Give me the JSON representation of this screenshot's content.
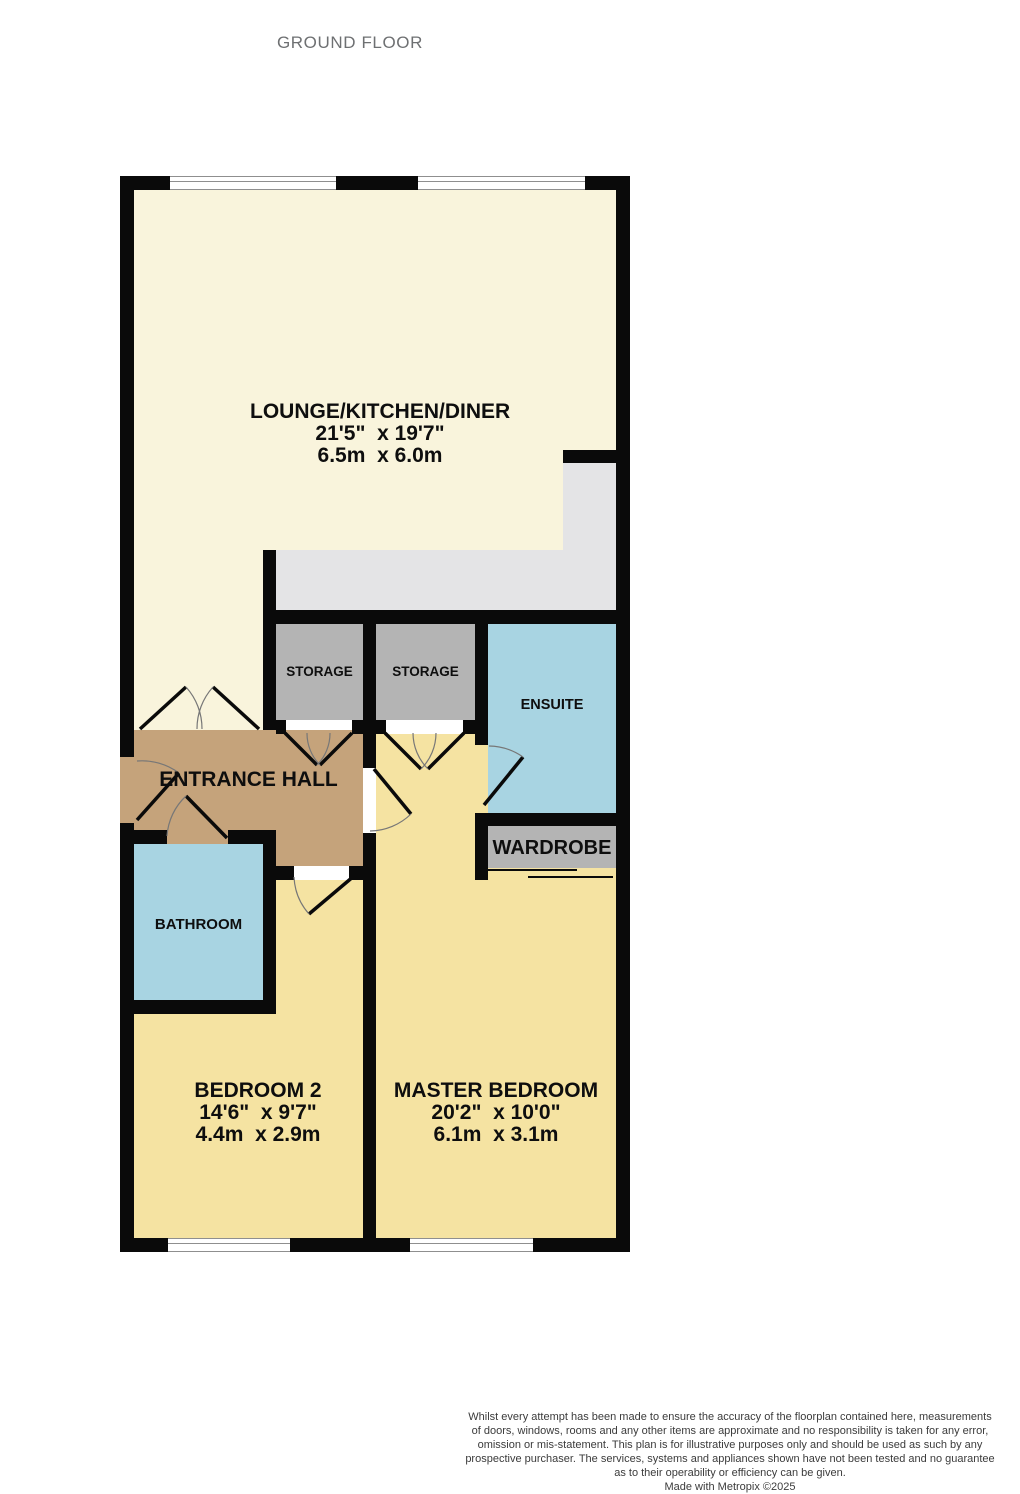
{
  "title": "GROUND FLOOR",
  "rooms": {
    "lounge": {
      "name": "LOUNGE/KITCHEN/DINER",
      "imperial": "21'5\"  x 19'7\"",
      "metric": "6.5m  x 6.0m"
    },
    "storage1": {
      "name": "STORAGE"
    },
    "storage2": {
      "name": "STORAGE"
    },
    "ensuite": {
      "name": "ENSUITE"
    },
    "entrance_hall": {
      "name": "ENTRANCE HALL"
    },
    "wardrobe": {
      "name": "WARDROBE"
    },
    "bathroom": {
      "name": "BATHROOM"
    },
    "bedroom2": {
      "name": "BEDROOM 2",
      "imperial": "14'6\"  x 9'7\"",
      "metric": "4.4m  x 2.9m"
    },
    "master": {
      "name": "MASTER BEDROOM",
      "imperial": "20'2\"  x 10'0\"",
      "metric": "6.1m  x 3.1m"
    }
  },
  "colors": {
    "wall": "#0a0a0a",
    "lounge": "#f9f4dc",
    "bedroom": "#f5e3a2",
    "hall": "#c5a37b",
    "storage": "#b4b4b4",
    "kitchen": "#e4e4e6",
    "bath": "#a8d4e2",
    "title": "#6e7072"
  },
  "footer": {
    "lines": [
      "Whilst every attempt has been made to ensure the accuracy of the floorplan contained here, measurements",
      "of doors, windows, rooms and any other items are approximate and no responsibility is taken for any error,",
      "omission or mis-statement. This plan is for illustrative purposes only and should be used as such by any",
      "prospective purchaser. The services, systems and appliances shown have not been tested and no guarantee",
      "as to their operability or efficiency can be given."
    ],
    "credit": "Made with Metropix ©2025"
  }
}
